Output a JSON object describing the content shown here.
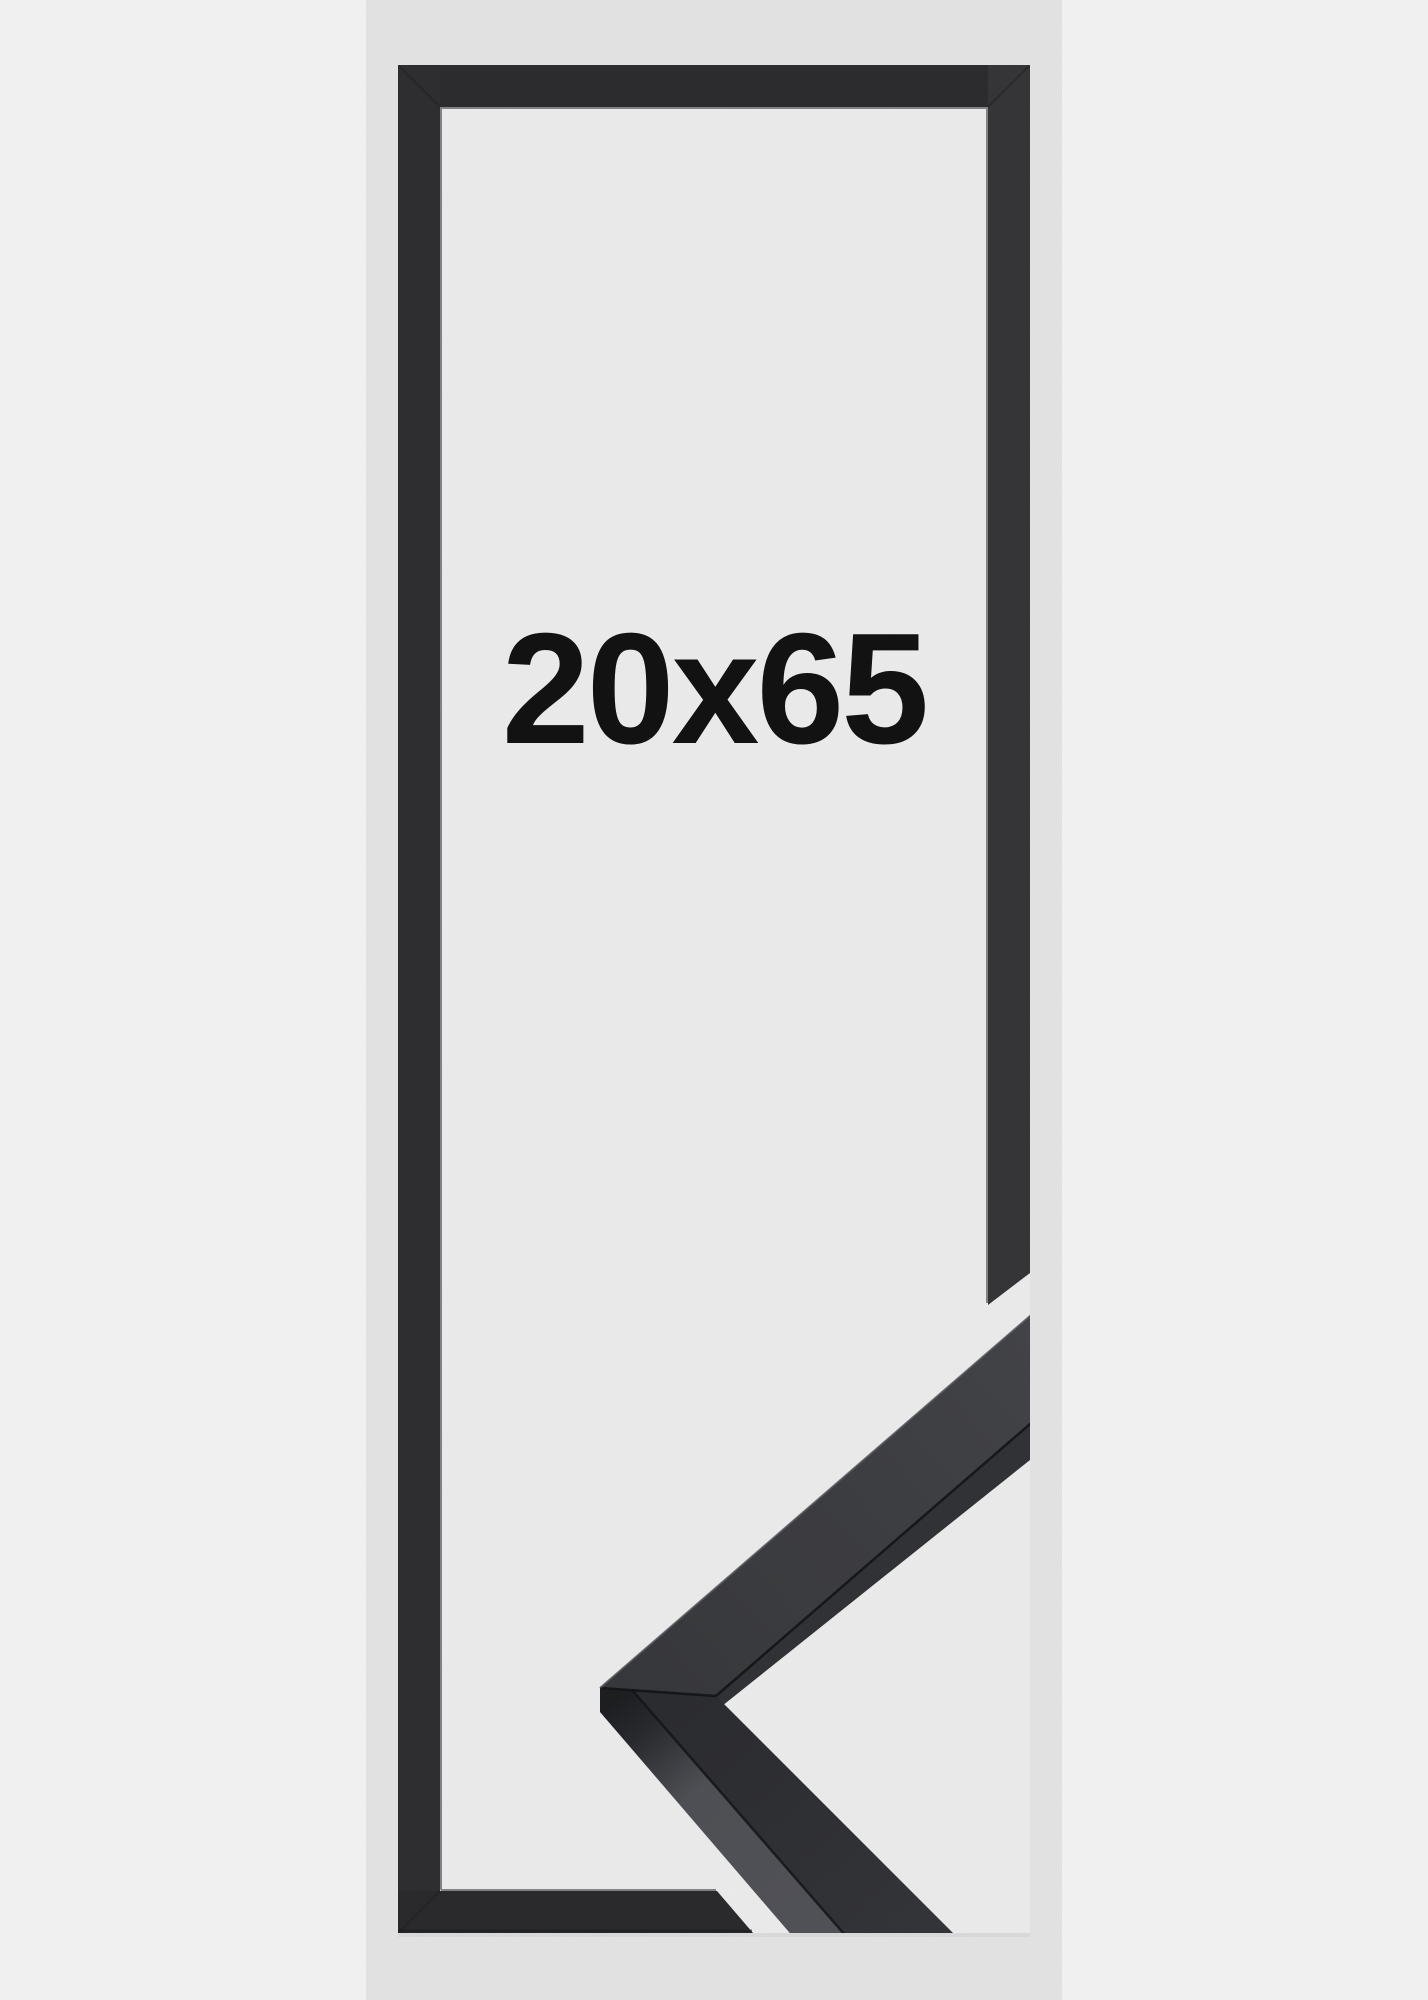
{
  "page": {
    "background_color": "#f0f0f1"
  },
  "product": {
    "size_label": "20x65",
    "colors": {
      "background": "#f0f0f1",
      "interior": "#f9f9fa",
      "frame_top": "#2f2f32",
      "frame_left": "#323235",
      "frame_right": "#39393c",
      "frame_bottom": "#2d2d30",
      "frame_edge": "#1e1f21",
      "sample_face_near": "#3a3b3f",
      "sample_face_far": "#47484c",
      "sample_strip": "#35363a",
      "sample_lower_near": "#2e2f33",
      "sample_lower_far": "#37383c",
      "sample_side_mid": "#54555a",
      "sample_side_far": "#56575c",
      "sample_end": "#1f2023",
      "sample_seam": "#141517",
      "sample_highlight": "#55565b",
      "label_text": "#121212"
    }
  }
}
